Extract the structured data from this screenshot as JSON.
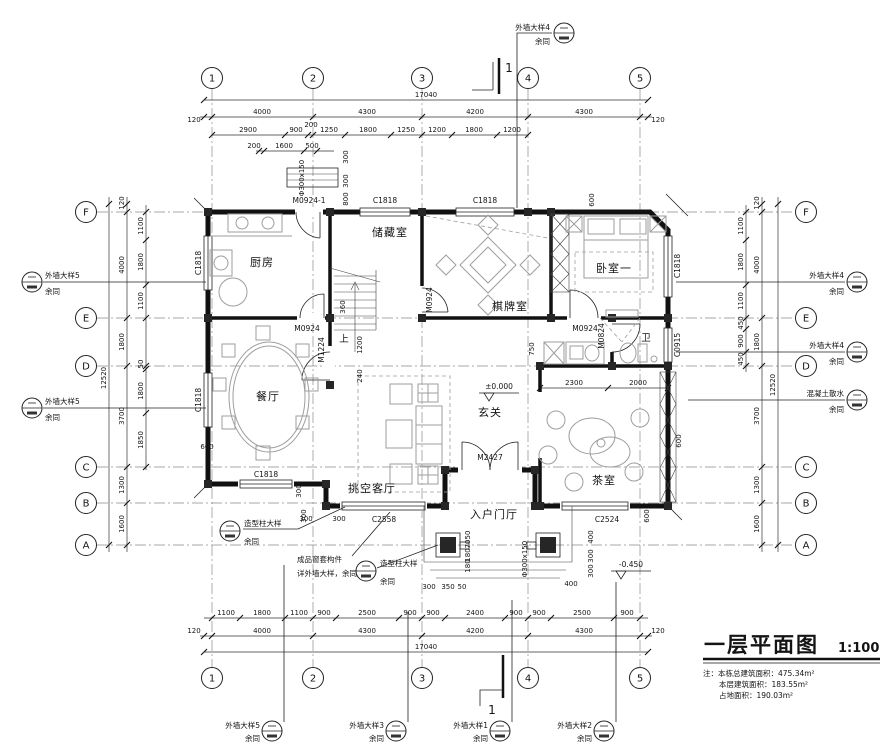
{
  "drawing": {
    "title": "一层平面图",
    "scale": "1:100",
    "notes": [
      "注：本栋总建筑面积：475.34m²",
      "本层建筑面积：183.55m²",
      "占地面积：190.03m²"
    ]
  },
  "grid": {
    "cols": [
      "1",
      "2",
      "3",
      "4",
      "5"
    ],
    "rows": [
      "F",
      "E",
      "D",
      "C",
      "B",
      "A"
    ]
  },
  "rooms": {
    "kitchen": "厨房",
    "storage": "储藏室",
    "chess": "棋牌室",
    "bedroom": "卧室一",
    "bath": "卫",
    "dining": "餐厅",
    "living": "挑空客厅",
    "foyer": "玄关",
    "tea": "茶室",
    "entry": "入户门厅"
  },
  "levels": {
    "main": "±0.000",
    "outdoor": "-0.450"
  },
  "stair": {
    "up": "上",
    "dims": [
      "360",
      "1200",
      "240"
    ]
  },
  "openings": {
    "m0924_1": "M0924-1",
    "m0924": "M0924",
    "m1224": "M1224",
    "m0824": "M0824",
    "m2427": "M2427",
    "c1818": "C1818",
    "c0915": "C0915",
    "c2558": "C2558",
    "c2524": "C2524"
  },
  "dims": {
    "top": {
      "total": "17040",
      "eave": "120",
      "spans": [
        "4000",
        "4300",
        "4200",
        "4300"
      ],
      "sub": [
        "2900",
        "900",
        "200",
        "1250",
        "1800",
        "1250",
        "1200",
        "1800",
        "1200"
      ],
      "sub2": [
        "200",
        "1600",
        "500"
      ],
      "flue": [
        "300",
        "300",
        "800"
      ],
      "flue_label": "Φ300x150"
    },
    "bottom": {
      "total": "17040",
      "eave": "120",
      "spans": [
        "4000",
        "4300",
        "4200",
        "4300"
      ],
      "sub": [
        "1100",
        "1800",
        "1100",
        "900",
        "2500",
        "900",
        "900",
        "2400",
        "900",
        "900",
        "2500",
        "900"
      ]
    },
    "left": {
      "total": "12520",
      "eave": "120",
      "outer": [
        "4000",
        "1800",
        "3700",
        "1300",
        "1600"
      ],
      "inner": [
        "1100",
        "1800",
        "1100",
        "50",
        "1800",
        "1850"
      ]
    },
    "right": {
      "total": "12520",
      "eave": "120",
      "outer": [
        "4000",
        "1800",
        "3700",
        "1300",
        "1600"
      ],
      "inner": [
        "1100",
        "1800",
        "1100",
        "450",
        "900",
        "450"
      ]
    },
    "plan": {
      "tea": [
        "2300",
        "2000"
      ],
      "bath": "750",
      "bedroom_offset": "600",
      "tea_east": "600",
      "tea_south": "600",
      "dining_west": "600",
      "porch": [
        "300",
        "350",
        "50",
        "400"
      ],
      "porch_right": [
        "400",
        "300",
        "300"
      ],
      "porch_left": [
        "300",
        "300"
      ],
      "porch_col": [
        "50",
        "70",
        "180",
        "180"
      ],
      "col_label": "Φ300x150",
      "corner": [
        "300",
        "300"
      ]
    }
  },
  "annotations": {
    "wall4": "外墙大样4",
    "wall5": "外墙大样5",
    "wall3": "外墙大样3",
    "wall1": "外墙大样1",
    "wall2": "外墙大样2",
    "same": "余同",
    "apron": "混凝土散水",
    "column": "造型柱大样",
    "trim1": "成品窗套构件",
    "trim2": "详外墙大样，余同"
  },
  "section": {
    "label": "1"
  }
}
